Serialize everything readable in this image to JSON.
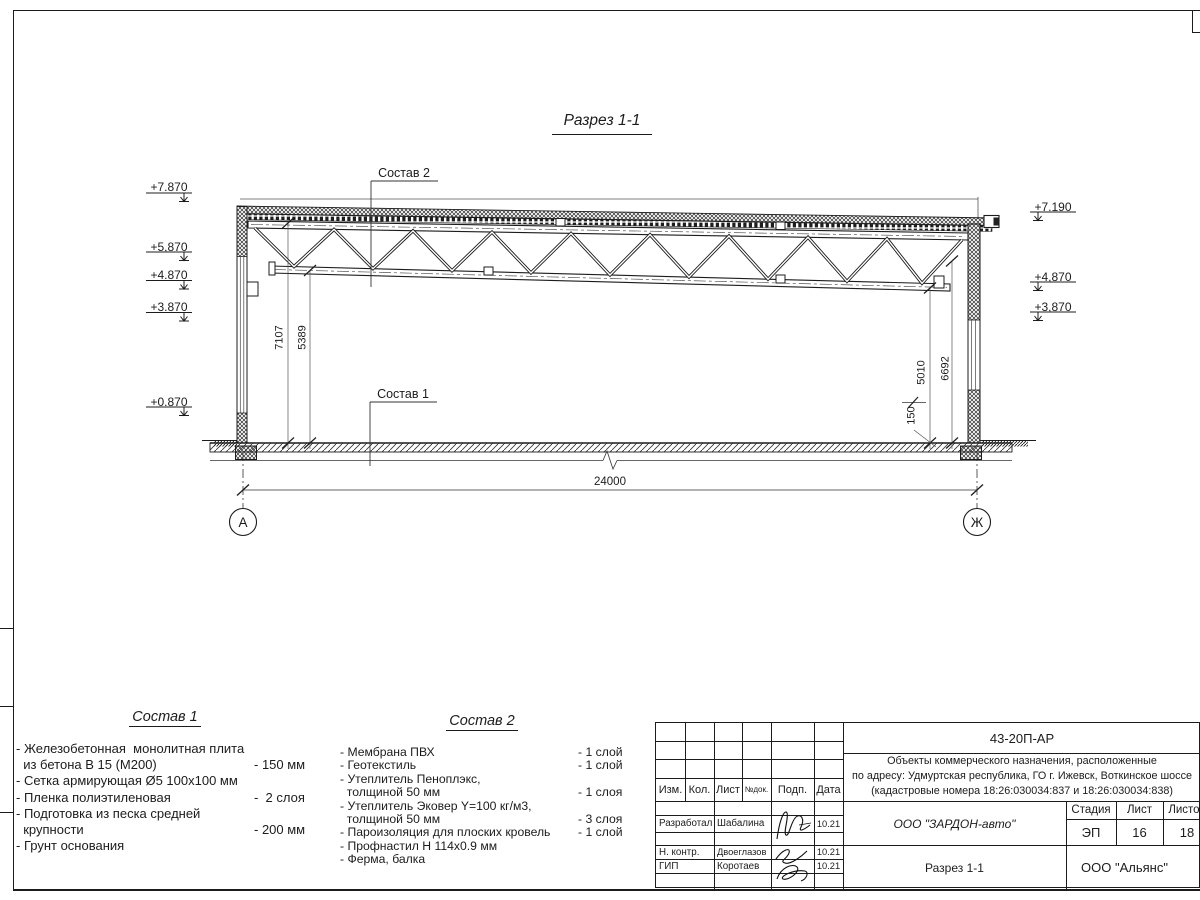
{
  "section": {
    "title": "Разрез 1-1",
    "callout_top": "Состав 2",
    "callout_bottom": "Состав 1",
    "elevations_left": [
      "+7.870",
      "+5,870",
      "+4.870",
      "+3.870",
      "+0.870"
    ],
    "elevations_right": [
      "+7.190",
      "+4,870",
      "+3,870"
    ],
    "dims": {
      "span": "24000",
      "left_h1": "7107",
      "left_h2": "5389",
      "right_h1": "5010",
      "right_h2": "6692",
      "slab": "150"
    },
    "axis_left": "А",
    "axis_right": "Ж"
  },
  "legend1": {
    "title": "Состав 1",
    "rows": [
      {
        "t": "- Железобетонная  монолитная плита",
        "v": ""
      },
      {
        "t": "  из бетона В 15 (М200)",
        "v": "- 150 мм"
      },
      {
        "t": "- Сетка армирующая Ø5 100х100 мм",
        "v": ""
      },
      {
        "t": "- Пленка полиэтиленовая",
        "v": "-  2 слоя"
      },
      {
        "t": "- Подготовка из песка средней",
        "v": ""
      },
      {
        "t": "  крупности",
        "v": "- 200 мм"
      },
      {
        "t": "- Грунт основания",
        "v": ""
      }
    ]
  },
  "legend2": {
    "title": "Состав 2",
    "rows": [
      {
        "t": "- Мембрана ПВХ",
        "v": "- 1 слой"
      },
      {
        "t": "- Геотекстиль",
        "v": "- 1 слой"
      },
      {
        "t": "- Утеплитель Пеноплэкс,",
        "v": ""
      },
      {
        "t": "  толщиной 50 мм",
        "v": "- 1 слоя"
      },
      {
        "t": "- Утеплитель Эковер Y=100 кг/м3,",
        "v": ""
      },
      {
        "t": "  толщиной 50 мм",
        "v": "- 3 слоя"
      },
      {
        "t": "- Пароизоляция для плоских кровель",
        "v": "- 1 слой"
      },
      {
        "t": "- Профнастил Н 114х0.9 мм",
        "v": ""
      },
      {
        "t": "- Ферма, балка",
        "v": ""
      }
    ]
  },
  "titleblock": {
    "code": "43-20П-АР",
    "desc1": "Объекты коммерческого назначения, расположенные",
    "desc2": "по адресу: Удмуртская республика, ГО г. Ижевск, Воткинское шоссе",
    "desc3": "(кадастровые номера 18:26:030034:837 и 18:26:030034:838)",
    "cols": {
      "izm": "Изм.",
      "kol": "Кол.",
      "list": "Лист",
      "ndoc": "№док.",
      "podp": "Подп.",
      "data": "Дата"
    },
    "rows": [
      {
        "role": "Разработал",
        "name": "Шабалина",
        "date": "10.21"
      },
      {
        "role": "Н. контр.",
        "name": "Двоеглазов",
        "date": "10.21"
      },
      {
        "role": "ГИП",
        "name": "Коротаев",
        "date": "10.21"
      }
    ],
    "company": "ООО \"ЗАРДОН-авто\"",
    "sheet_title": "Разрез 1-1",
    "org": "ООО \"Альянс\"",
    "stage_label": "Стадия",
    "sheet_label": "Лист",
    "sheets_label": "Листов",
    "stage": "ЭП",
    "sheet": "16",
    "sheets": "18"
  }
}
